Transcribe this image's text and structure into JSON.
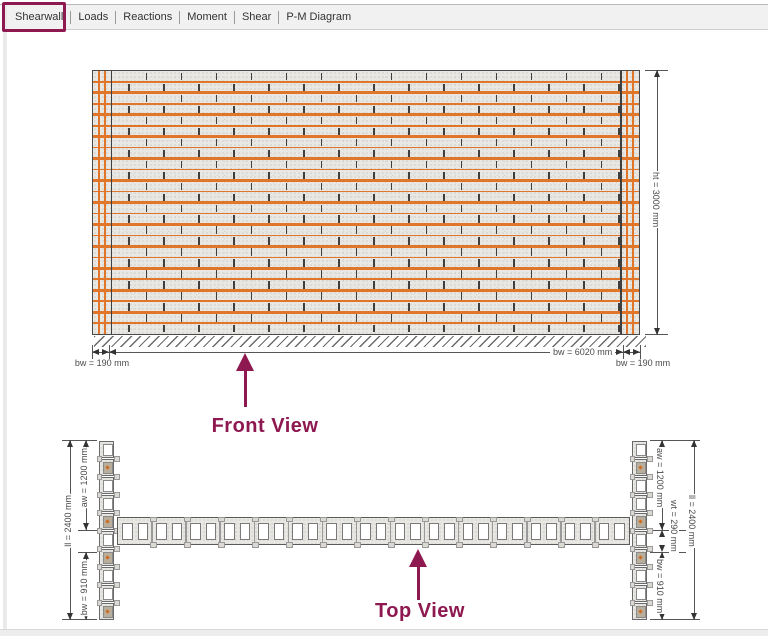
{
  "tabs": {
    "items": [
      {
        "label": "Shearwall",
        "active": true
      },
      {
        "label": "Loads",
        "active": false
      },
      {
        "label": "Reactions",
        "active": false
      },
      {
        "label": "Moment",
        "active": false
      },
      {
        "label": "Shear",
        "active": false
      },
      {
        "label": "P-M Diagram",
        "active": false
      }
    ],
    "highlight_color": "#8e1850"
  },
  "front_view": {
    "label": "Front View",
    "dims": {
      "height": "ht = 3000 mm",
      "web_width": "bw = 6020 mm",
      "flange_left": "bw = 190 mm",
      "flange_right": "bw = 190 mm"
    },
    "structure": {
      "course_rows": 24,
      "joint_spacing_px": 35,
      "flange_strip_px": 17.5,
      "flange_bars_per_end": 2
    },
    "colors": {
      "block_fill": "#e9e7e3",
      "joint": "#3f3f3f",
      "rebar": "#e0762a",
      "outline": "#4a4a4a"
    }
  },
  "top_view": {
    "label": "Top View",
    "dims_left": {
      "overall": "ll = 2400 mm",
      "aw": "aw = 1200 mm",
      "bw": "bw = 910 mm"
    },
    "dims_right": {
      "aw": "aw = 1200 mm",
      "wt": "wt = 290 mm",
      "bw": "bw = 910 mm",
      "overall": "ll = 2400 mm"
    },
    "structure": {
      "flange_blocks": 10,
      "grouted_cell_indices": [
        1,
        4,
        6,
        9
      ],
      "web_blocks": 15,
      "cells_per_block": 2
    },
    "colors": {
      "grout_fill": "#b9ad9b",
      "grout_dot": "#cf6b1f",
      "cell_fill": "#ffffff",
      "mortar_notch": "#dcd9d4"
    }
  },
  "annotation": {
    "color": "#8e1850"
  }
}
